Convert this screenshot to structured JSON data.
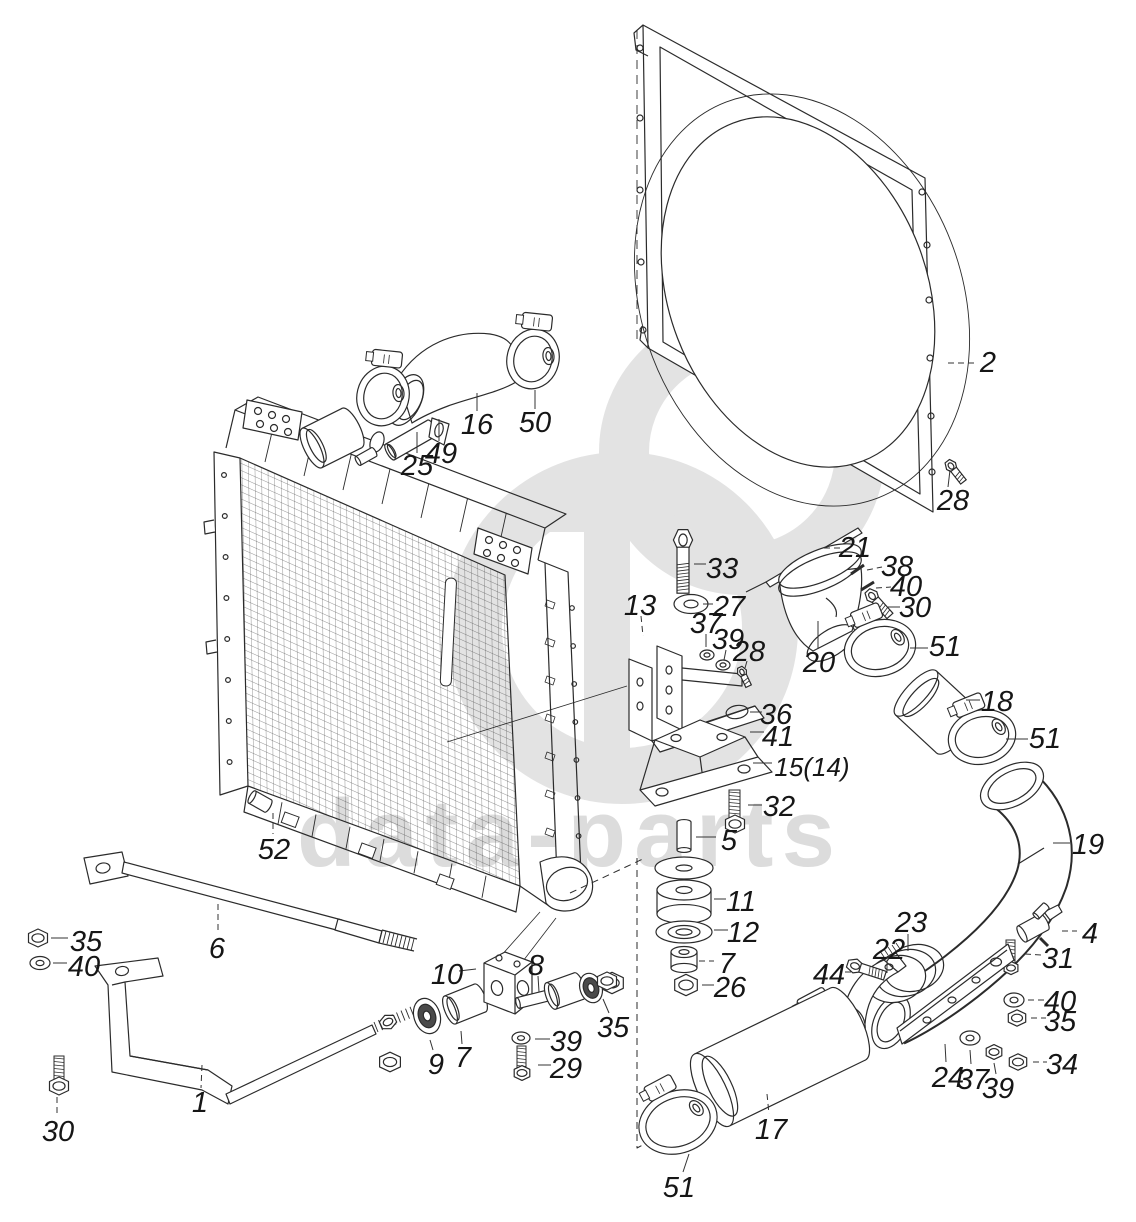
{
  "canvas": {
    "width": 1136,
    "height": 1222
  },
  "style": {
    "background": "#ffffff",
    "line_color": "#2b2b2b",
    "label_color": "#161616",
    "watermark_color": "#dcdcdc",
    "watermark_logo_color": "#e3e3e3"
  },
  "watermark": {
    "text": "data-parts",
    "logo": "dp-monogram"
  },
  "diagram": {
    "type": "exploded-parts-diagram",
    "subject": "radiator-and-fan-shroud-assembly",
    "callouts": [
      {
        "label": "2",
        "x": 988,
        "y": 362,
        "leader": [
          [
            948,
            363
          ],
          [
            974,
            363
          ]
        ],
        "dashed": true
      },
      {
        "label": "28",
        "x": 953,
        "y": 500,
        "leader": [
          [
            950,
            470
          ],
          [
            948,
            487
          ]
        ],
        "dashed": false
      },
      {
        "label": "50",
        "x": 535,
        "y": 422,
        "leader": [
          [
            535,
            390
          ],
          [
            535,
            409
          ]
        ],
        "dashed": false
      },
      {
        "label": "16",
        "x": 477,
        "y": 424,
        "leader": [
          [
            477,
            393
          ],
          [
            477,
            411
          ]
        ],
        "dashed": false
      },
      {
        "label": "49",
        "x": 441,
        "y": 453,
        "leader": [
          [
            439,
            419
          ],
          [
            439,
            441
          ]
        ],
        "dashed": false
      },
      {
        "label": "25",
        "x": 417,
        "y": 465,
        "leader": [
          [
            417,
            432
          ],
          [
            417,
            453
          ]
        ],
        "dashed": false
      },
      {
        "label": "33",
        "x": 722,
        "y": 568,
        "leader": [
          [
            694,
            564
          ],
          [
            706,
            564
          ]
        ],
        "dashed": false
      },
      {
        "label": "27",
        "x": 729,
        "y": 606,
        "leader": [
          [
            703,
            604
          ],
          [
            713,
            604
          ]
        ],
        "dashed": false
      },
      {
        "label": "13",
        "x": 640,
        "y": 605,
        "leader": [
          [
            641,
            616
          ],
          [
            643,
            636
          ]
        ],
        "dashed": true
      },
      {
        "label": "37",
        "x": 706,
        "y": 623,
        "leader": [
          [
            706,
            634
          ],
          [
            706,
            647
          ]
        ],
        "dashed": false
      },
      {
        "label": "39",
        "x": 728,
        "y": 639,
        "leader": [
          [
            726,
            650
          ],
          [
            724,
            660
          ]
        ],
        "dashed": false
      },
      {
        "label": "28",
        "x": 749,
        "y": 651,
        "leader": [
          [
            747,
            661
          ],
          [
            745,
            668
          ]
        ],
        "dashed": false
      },
      {
        "label": "21",
        "x": 855,
        "y": 547,
        "leader": [
          [
            824,
            548
          ],
          [
            840,
            548
          ]
        ],
        "dashed": true
      },
      {
        "label": "38",
        "x": 897,
        "y": 566,
        "leader": [
          [
            867,
            570
          ],
          [
            882,
            567
          ]
        ],
        "dashed": true
      },
      {
        "label": "40",
        "x": 906,
        "y": 586,
        "leader": [
          [
            876,
            588
          ],
          [
            891,
            587
          ]
        ],
        "dashed": true
      },
      {
        "label": "30",
        "x": 915,
        "y": 607,
        "leader": [
          [
            888,
            607
          ],
          [
            900,
            607
          ]
        ],
        "dashed": false
      },
      {
        "label": "20",
        "x": 819,
        "y": 662,
        "leader": [
          [
            818,
            621
          ],
          [
            818,
            649
          ]
        ],
        "dashed": false
      },
      {
        "label": "51",
        "x": 945,
        "y": 646,
        "leader": [
          [
            910,
            648
          ],
          [
            928,
            648
          ]
        ],
        "dashed": false
      },
      {
        "label": "18",
        "x": 997,
        "y": 701,
        "leader": [
          [
            966,
            700
          ],
          [
            980,
            700
          ]
        ],
        "dashed": false
      },
      {
        "label": "51",
        "x": 1045,
        "y": 738,
        "leader": [
          [
            1006,
            739
          ],
          [
            1028,
            739
          ]
        ],
        "dashed": false
      },
      {
        "label": "19",
        "x": 1088,
        "y": 844,
        "leader": [
          [
            1053,
            843
          ],
          [
            1070,
            843
          ]
        ],
        "dashed": false
      },
      {
        "label": "36",
        "x": 776,
        "y": 714,
        "leader": [
          [
            750,
            712
          ],
          [
            762,
            712
          ]
        ],
        "dashed": false
      },
      {
        "label": "41",
        "x": 778,
        "y": 736,
        "leader": [
          [
            750,
            732
          ],
          [
            764,
            732
          ]
        ],
        "dashed": false
      },
      {
        "label": "15(14)",
        "x": 812,
        "y": 766,
        "leader": [
          [
            753,
            763
          ],
          [
            772,
            763
          ]
        ],
        "dashed": false
      },
      {
        "label": "32",
        "x": 779,
        "y": 806,
        "leader": [
          [
            748,
            805
          ],
          [
            762,
            805
          ]
        ],
        "dashed": false
      },
      {
        "label": "5",
        "x": 729,
        "y": 840,
        "leader": [
          [
            696,
            837
          ],
          [
            716,
            837
          ]
        ],
        "dashed": false
      },
      {
        "label": "11",
        "x": 741,
        "y": 901,
        "leader": [
          [
            714,
            899
          ],
          [
            726,
            899
          ]
        ],
        "dashed": false
      },
      {
        "label": "12",
        "x": 743,
        "y": 932,
        "leader": [
          [
            714,
            930
          ],
          [
            728,
            930
          ]
        ],
        "dashed": false
      },
      {
        "label": "7",
        "x": 727,
        "y": 963,
        "leader": [
          [
            699,
            961
          ],
          [
            714,
            961
          ]
        ],
        "dashed": true
      },
      {
        "label": "26",
        "x": 730,
        "y": 987,
        "leader": [
          [
            702,
            985
          ],
          [
            714,
            985
          ]
        ],
        "dashed": false
      },
      {
        "label": "23",
        "x": 911,
        "y": 922,
        "leader": [
          [
            908,
            934
          ],
          [
            908,
            951
          ]
        ],
        "dashed": false
      },
      {
        "label": "22",
        "x": 889,
        "y": 949,
        "leader": [
          [
            887,
            960
          ],
          [
            887,
            973
          ]
        ],
        "dashed": false
      },
      {
        "label": "44",
        "x": 829,
        "y": 974,
        "leader": [
          [
            845,
            972
          ],
          [
            855,
            972
          ]
        ],
        "dashed": true
      },
      {
        "label": "4",
        "x": 1090,
        "y": 933,
        "leader": [
          [
            1062,
            931
          ],
          [
            1077,
            931
          ]
        ],
        "dashed": true
      },
      {
        "label": "31",
        "x": 1058,
        "y": 958,
        "leader": [
          [
            1025,
            954
          ],
          [
            1042,
            955
          ]
        ],
        "dashed": true
      },
      {
        "label": "40",
        "x": 1060,
        "y": 1001,
        "leader": [
          [
            1028,
            1000
          ],
          [
            1045,
            1000
          ]
        ],
        "dashed": true
      },
      {
        "label": "35",
        "x": 1060,
        "y": 1021,
        "leader": [
          [
            1031,
            1018
          ],
          [
            1046,
            1018
          ]
        ],
        "dashed": true
      },
      {
        "label": "34",
        "x": 1062,
        "y": 1064,
        "leader": [
          [
            1033,
            1062
          ],
          [
            1047,
            1062
          ]
        ],
        "dashed": true
      },
      {
        "label": "24",
        "x": 948,
        "y": 1077,
        "leader": [
          [
            945,
            1044
          ],
          [
            946,
            1062
          ]
        ],
        "dashed": false
      },
      {
        "label": "37",
        "x": 973,
        "y": 1079,
        "leader": [
          [
            970,
            1050
          ],
          [
            971,
            1064
          ]
        ],
        "dashed": false
      },
      {
        "label": "39",
        "x": 998,
        "y": 1088,
        "leader": [
          [
            994,
            1063
          ],
          [
            996,
            1074
          ]
        ],
        "dashed": false
      },
      {
        "label": "17",
        "x": 771,
        "y": 1129,
        "leader": [
          [
            767,
            1094
          ],
          [
            769,
            1114
          ]
        ],
        "dashed": true
      },
      {
        "label": "51",
        "x": 679,
        "y": 1187,
        "leader": [
          [
            689,
            1154
          ],
          [
            683,
            1172
          ]
        ],
        "dashed": false
      },
      {
        "label": "52",
        "x": 274,
        "y": 849,
        "leader": [
          [
            273,
            813
          ],
          [
            273,
            834
          ]
        ],
        "dashed": true
      },
      {
        "label": "6",
        "x": 217,
        "y": 948,
        "leader": [
          [
            218,
            904
          ],
          [
            218,
            932
          ]
        ],
        "dashed": true
      },
      {
        "label": "35",
        "x": 86,
        "y": 941,
        "leader": [
          [
            51,
            938
          ],
          [
            68,
            938
          ]
        ],
        "dashed": false
      },
      {
        "label": "40",
        "x": 84,
        "y": 966,
        "leader": [
          [
            53,
            963
          ],
          [
            67,
            963
          ]
        ],
        "dashed": false
      },
      {
        "label": "30",
        "x": 58,
        "y": 1131,
        "leader": [
          [
            57,
            1097
          ],
          [
            57,
            1117
          ]
        ],
        "dashed": true
      },
      {
        "label": "1",
        "x": 200,
        "y": 1102,
        "leader": [
          [
            202,
            1065
          ],
          [
            201,
            1088
          ]
        ],
        "dashed": true
      },
      {
        "label": "9",
        "x": 436,
        "y": 1064,
        "leader": [
          [
            430,
            1040
          ],
          [
            433,
            1050
          ]
        ],
        "dashed": false
      },
      {
        "label": "7",
        "x": 463,
        "y": 1057,
        "leader": [
          [
            461,
            1031
          ],
          [
            462,
            1044
          ]
        ],
        "dashed": false
      },
      {
        "label": "10",
        "x": 447,
        "y": 974,
        "leader": [
          [
            459,
            971
          ],
          [
            476,
            969
          ]
        ],
        "dashed": false
      },
      {
        "label": "8",
        "x": 536,
        "y": 965,
        "leader": [
          [
            538,
            976
          ],
          [
            539,
            992
          ]
        ],
        "dashed": false
      },
      {
        "label": "39",
        "x": 566,
        "y": 1041,
        "leader": [
          [
            535,
            1039
          ],
          [
            550,
            1039
          ]
        ],
        "dashed": false
      },
      {
        "label": "29",
        "x": 566,
        "y": 1068,
        "leader": [
          [
            538,
            1065
          ],
          [
            551,
            1065
          ]
        ],
        "dashed": false
      },
      {
        "label": "35",
        "x": 613,
        "y": 1027,
        "leader": [
          [
            603,
            999
          ],
          [
            609,
            1013
          ]
        ],
        "dashed": false
      }
    ]
  }
}
